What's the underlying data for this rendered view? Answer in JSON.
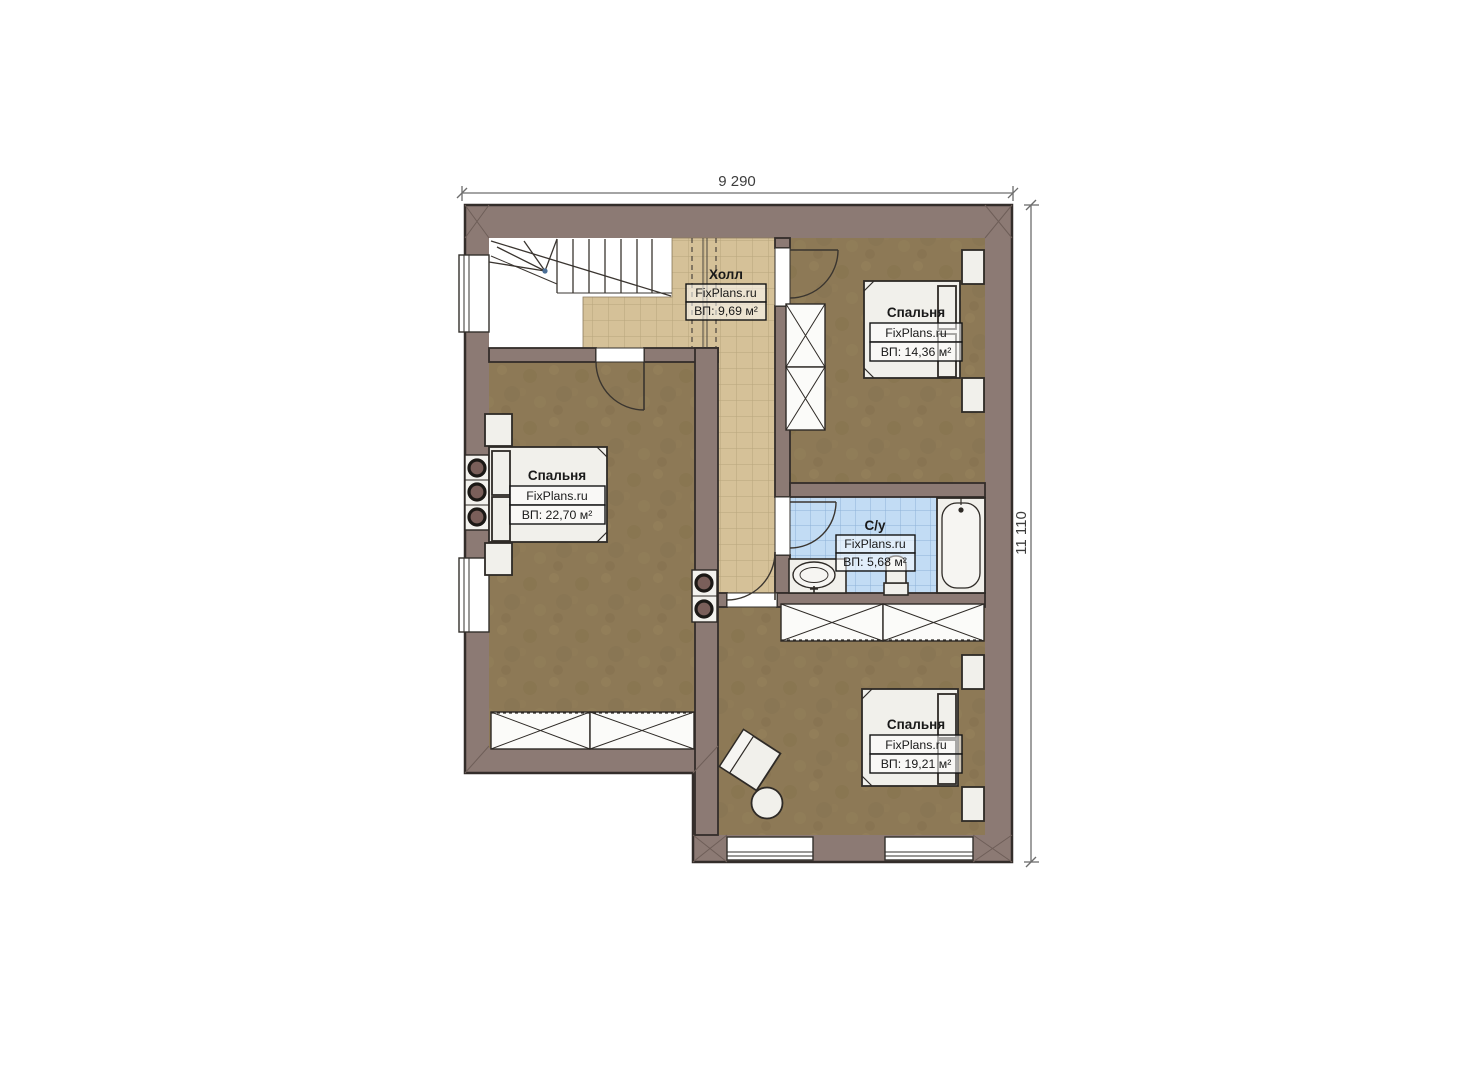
{
  "plan": {
    "type": "floor-plan",
    "branding_watermark": "FixPlans.ru",
    "dimensions": {
      "width_label": "9 290",
      "height_label": "11 110"
    },
    "rooms": {
      "hall": {
        "name": "Холл",
        "watermark": "FixPlans.ru",
        "area": "ВП: 9,69 м²"
      },
      "bedroom_top": {
        "name": "Спальня",
        "watermark": "FixPlans.ru",
        "area": "ВП: 14,36 м²"
      },
      "bedroom_left": {
        "name": "Спальня",
        "watermark": "FixPlans.ru",
        "area": "ВП: 22,70 м²"
      },
      "bathroom": {
        "name": "С/у",
        "watermark": "FixPlans.ru",
        "area": "ВП: 5,68 м²"
      },
      "bedroom_bottom": {
        "name": "Спальня",
        "watermark": "FixPlans.ru",
        "area": "ВП: 19,21 м²"
      }
    },
    "colors": {
      "wall": "#8c7a74",
      "outline": "#332d2a",
      "floor_hall": "#d5c198",
      "floor_bedroom": "#8d7956",
      "floor_bathroom": "#c2dcf4",
      "furniture": "#f1f0eb"
    }
  }
}
